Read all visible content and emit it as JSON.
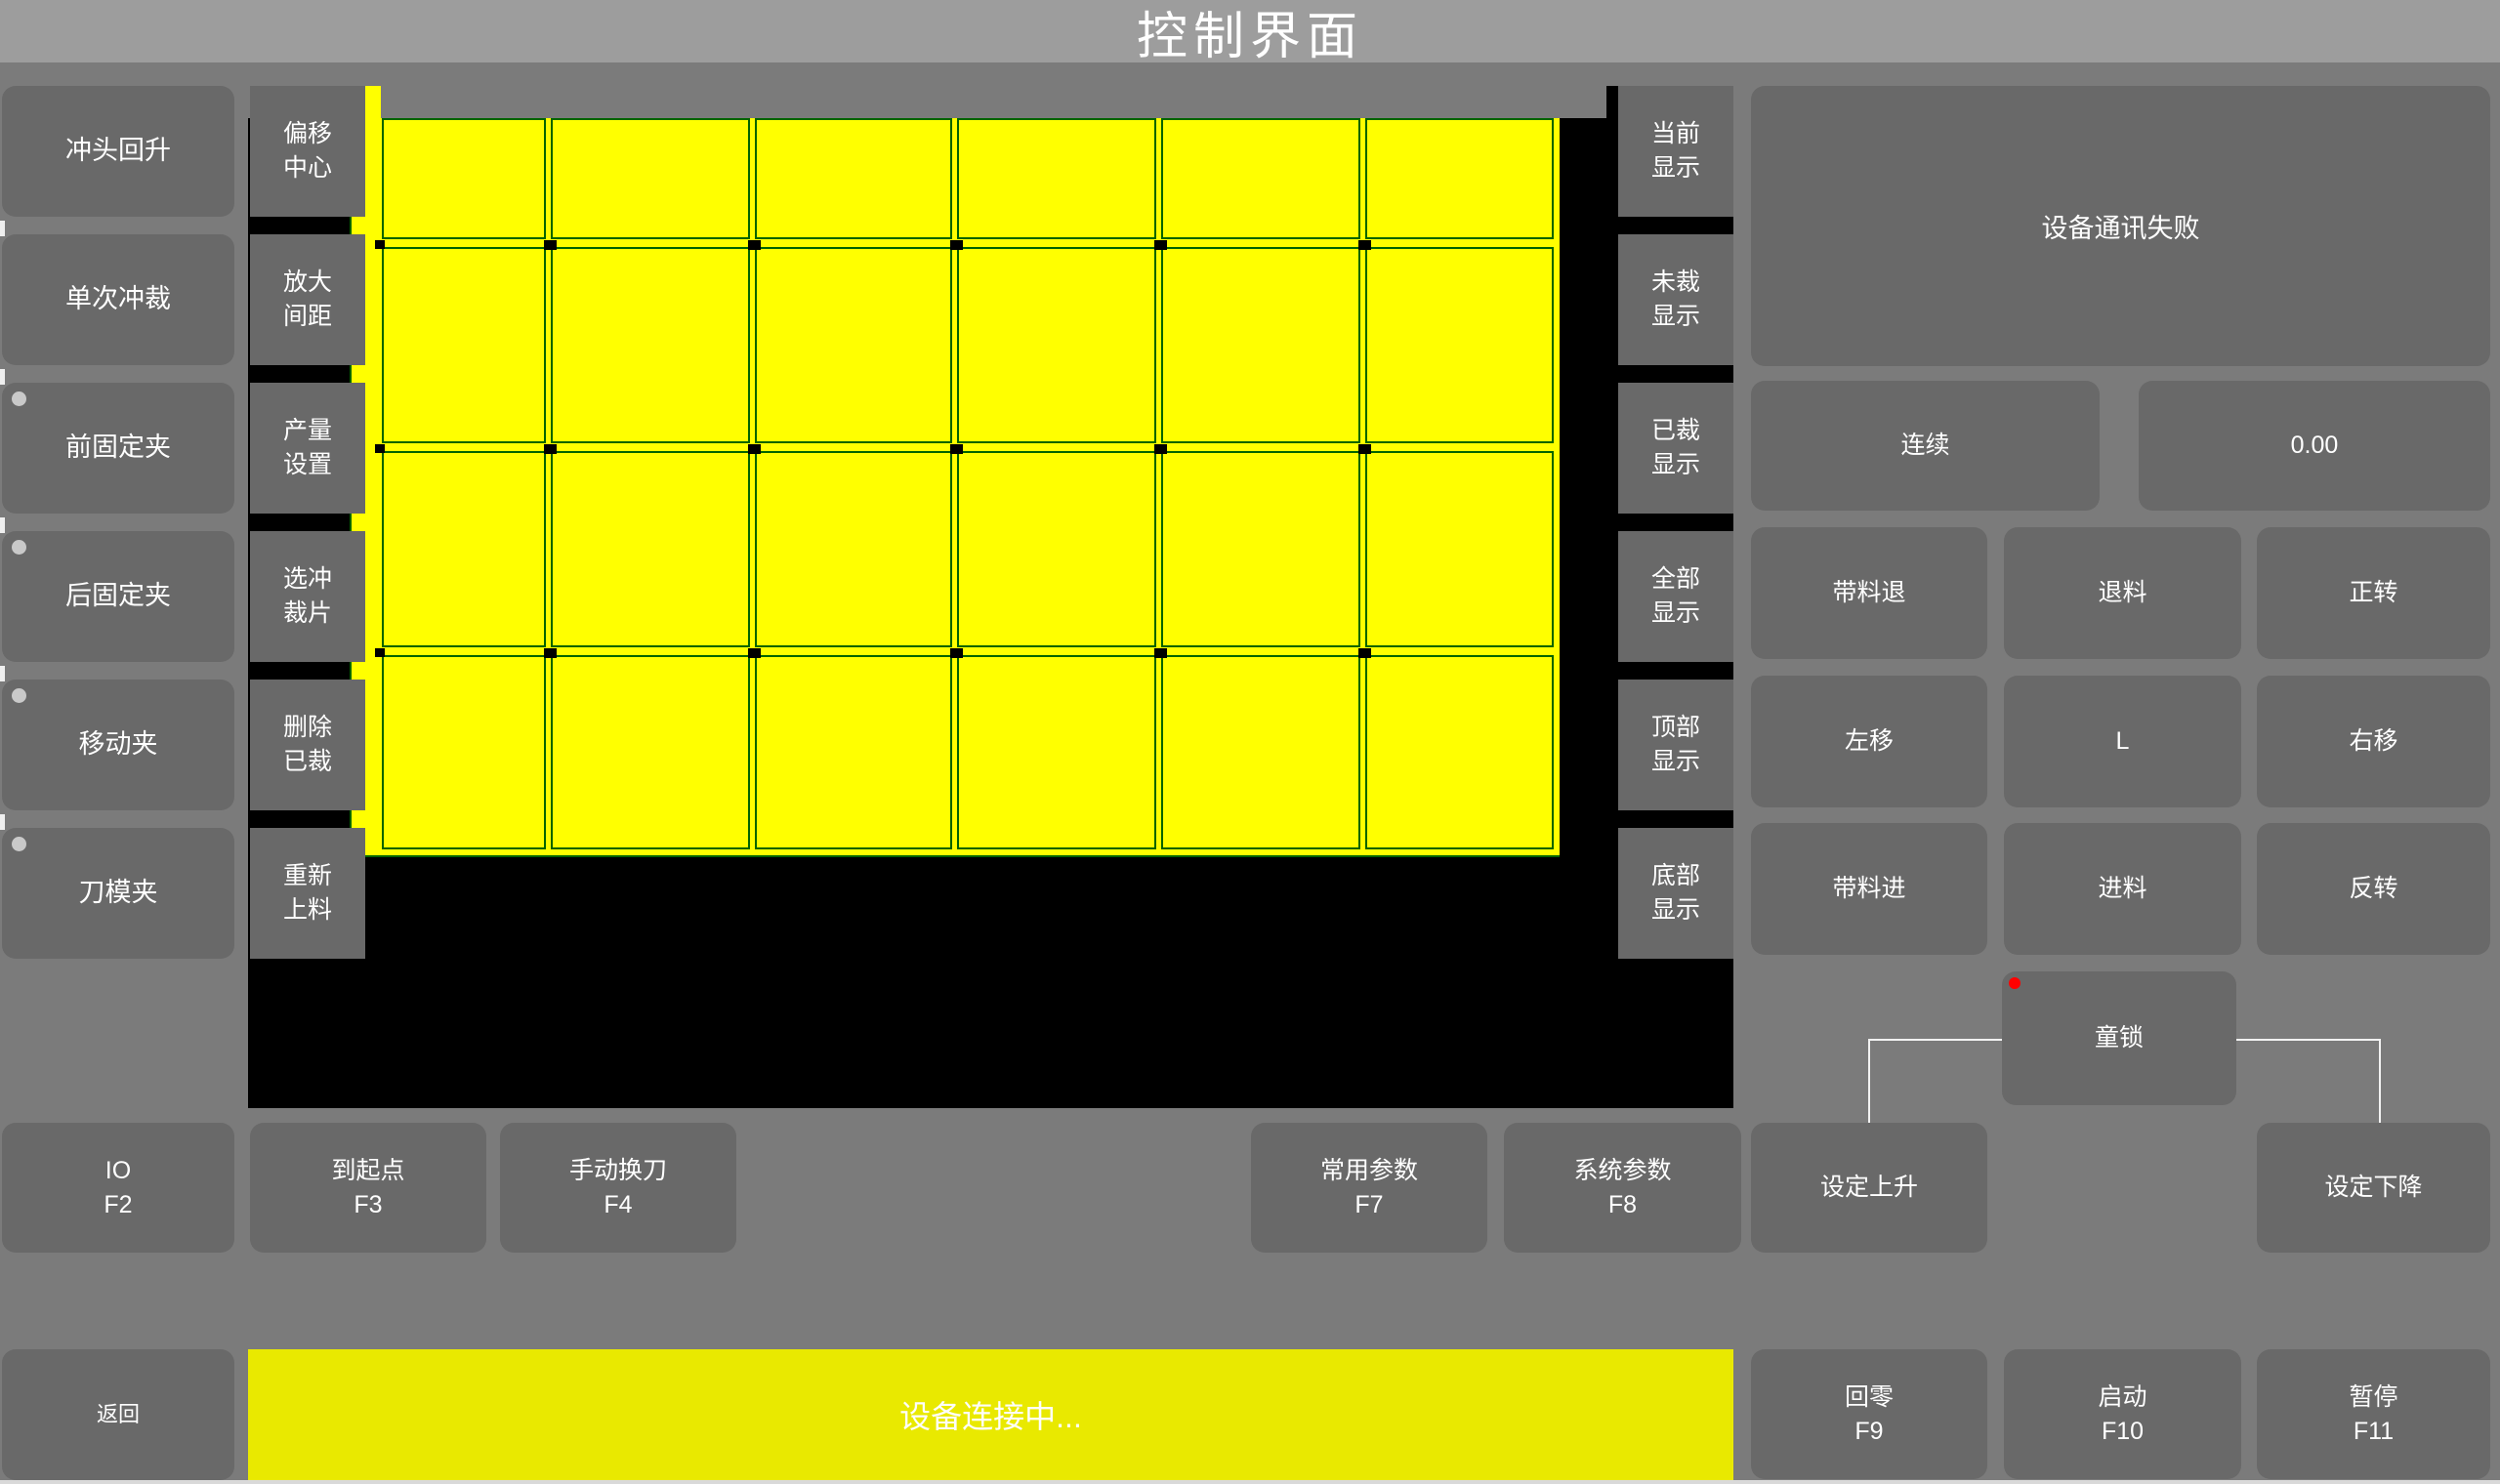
{
  "title": "控制界面",
  "left_column": {
    "items": [
      {
        "label": "冲头回升",
        "indicator": false
      },
      {
        "label": "单次冲裁",
        "indicator": false
      },
      {
        "label": "前固定夹",
        "indicator": true
      },
      {
        "label": "后固定夹",
        "indicator": true
      },
      {
        "label": "移动夹",
        "indicator": true
      },
      {
        "label": "刀模夹",
        "indicator": true
      }
    ]
  },
  "tool_column": {
    "items": [
      {
        "label": "偏移\n中心"
      },
      {
        "label": "放大\n间距"
      },
      {
        "label": "产量\n设置"
      },
      {
        "label": "选冲\n裁片"
      },
      {
        "label": "删除\n已裁"
      },
      {
        "label": "重新\n上料"
      }
    ]
  },
  "display_column": {
    "items": [
      {
        "label": "当前\n显示"
      },
      {
        "label": "未裁\n显示"
      },
      {
        "label": "已裁\n显示"
      },
      {
        "label": "全部\n显示"
      },
      {
        "label": "顶部\n显示"
      },
      {
        "label": "底部\n显示"
      }
    ]
  },
  "canvas": {
    "columns": 6,
    "rows": 4,
    "background": "#000000",
    "sheet_color": "#ffff00",
    "cell_border_color": "#006400"
  },
  "right_panel": {
    "message": "设备通讯失败",
    "mode_button": "连续",
    "value_display": "0.00",
    "jog_grid": [
      [
        "带料退",
        "退料",
        "正转"
      ],
      [
        "左移",
        "L",
        "右移"
      ],
      [
        "带料进",
        "进料",
        "反转"
      ]
    ],
    "child_lock": "童锁"
  },
  "bottom_row": {
    "items": [
      {
        "label": "IO\nF2"
      },
      {
        "label": "到起点\nF3"
      },
      {
        "label": "手动换刀\nF4"
      },
      {
        "label": "常用参数\nF7"
      },
      {
        "label": "系统参数\nF8"
      },
      {
        "label": "设定上升"
      },
      {
        "label": "设定下降"
      }
    ]
  },
  "status_bar": {
    "back": "返回",
    "message": "设备连接中...",
    "buttons": [
      {
        "label": "回零\nF9"
      },
      {
        "label": "启动\nF10"
      },
      {
        "label": "暂停\nF11"
      }
    ]
  },
  "colors": {
    "page_bg": "#7b7b7b",
    "titlebar_bg": "#9d9d9d",
    "button_bg": "#696969",
    "canvas_bg": "#000000",
    "sheet_yellow": "#ffff00",
    "cut_border_green": "#006400",
    "statusbar_yellow": "#e9e900",
    "alert_red": "#ff0000",
    "indicator_gray": "#c9c9c9"
  }
}
